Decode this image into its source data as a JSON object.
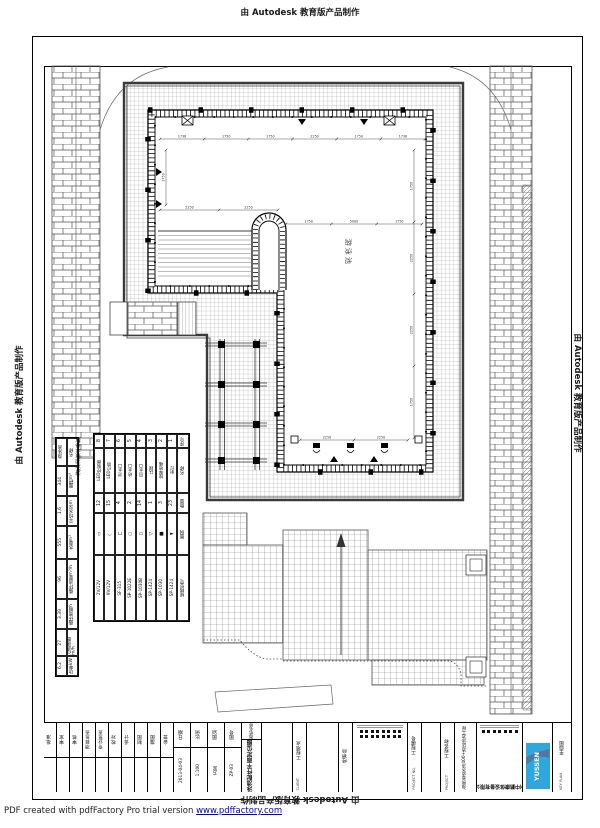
{
  "page": {
    "autodesk_stamp": "由 Autodesk 教育版产品制作",
    "pdf_footer_text": "PDF created with pdfFactory Pro trial version ",
    "pdf_footer_link": "www.pdffactory.com"
  },
  "colors": {
    "logo_blue": "#2fa7dd",
    "logo_swoosh": "#53779f",
    "link_blue": "#0000cc",
    "line_black": "#000000",
    "grid_gray": "#9a9a9a"
  },
  "pool": {
    "label": "游泳池"
  },
  "params_table": {
    "title": "游泳池技术参数",
    "rows": [
      [
        "游泳池",
        "名称"
      ],
      [
        "344",
        "面积m²"
      ],
      [
        "1.6",
        "平均水深m"
      ],
      [
        "555",
        "水量m³"
      ],
      [
        "96",
        "循环流量m³/h"
      ],
      [
        "3.39",
        "循环周期h"
      ],
      [
        "27",
        "过滤速度m/h"
      ],
      [
        "6.2",
        "功率kW"
      ]
    ],
    "row_heights": [
      28,
      30,
      30,
      33,
      40,
      30,
      27,
      20
    ]
  },
  "equipment_table": {
    "headers": [
      "序号",
      "名称",
      "数量",
      "图例",
      "规格型号"
    ],
    "row_heights": [
      14,
      45,
      20,
      42,
      66
    ],
    "items": [
      {
        "no": "1",
        "name": "射灯",
        "qty": "23",
        "symbol": "►",
        "model": "SP-1424"
      },
      {
        "no": "2",
        "name": "按摩喷嘴",
        "qty": "3",
        "symbol": "■",
        "model": "SP-1030"
      },
      {
        "no": "3",
        "name": "扶梯",
        "qty": "1",
        "symbol": "▷",
        "model": "SP-1424"
      },
      {
        "no": "4",
        "name": "回水口",
        "qty": "14",
        "symbol": "▭",
        "model": "SP-1030B"
      },
      {
        "no": "5",
        "name": "给水口",
        "qty": "2",
        "symbol": "○",
        "model": "SP-1022E"
      },
      {
        "no": "6",
        "name": "泄水口",
        "qty": "4",
        "symbol": "⊔",
        "model": "SF-315"
      },
      {
        "no": "7",
        "name": "LED灯带",
        "qty": "15",
        "symbol": "◡",
        "model": "9V/12V"
      },
      {
        "no": "8",
        "name": "LED控制器",
        "qty": "12",
        "symbol": "▯",
        "model": "2V/12V"
      }
    ]
  },
  "dims": {
    "top": [
      "1738",
      "1750",
      "1750",
      "2250",
      "1750",
      "1738"
    ],
    "left_lobe": [
      "2250",
      "2250"
    ],
    "mid": [
      "1750",
      "5000",
      "1750"
    ],
    "bottom": [
      "2250",
      "2250"
    ],
    "right": [
      "1750",
      "2250",
      "2250",
      "1750"
    ],
    "left": [
      "1750"
    ]
  },
  "titleblock": {
    "cells": [
      {
        "type": "sig",
        "w": 13,
        "label": "批准"
      },
      {
        "type": "sig",
        "w": 13,
        "label": "审定"
      },
      {
        "type": "sig",
        "w": 13,
        "label": "审核"
      },
      {
        "type": "sig",
        "w": 13,
        "label": "项目负责"
      },
      {
        "type": "sig",
        "w": 13,
        "label": "专业负责"
      },
      {
        "type": "sig",
        "w": 13,
        "label": "校对"
      },
      {
        "type": "sig",
        "w": 13,
        "label": "设计"
      },
      {
        "type": "sig",
        "w": 13,
        "label": "制图"
      },
      {
        "type": "sig",
        "w": 13,
        "label": "描图"
      },
      {
        "type": "sig",
        "w": 13,
        "label": "会签"
      },
      {
        "type": "kv",
        "w": 17,
        "k": "日期",
        "v": "2013-04-03"
      },
      {
        "type": "kv",
        "w": 17,
        "k": "比例",
        "v": "1:100"
      },
      {
        "type": "kv",
        "w": 17,
        "k": "图别",
        "v": "方案"
      },
      {
        "type": "kv",
        "w": 17,
        "k": "图号",
        "v": "ZP-03"
      },
      {
        "type": "title",
        "w": 20,
        "label": "图纸名称",
        "en": "TITLE",
        "value": "泳池配件平面定位图"
      },
      {
        "type": "blank",
        "w": 28
      },
      {
        "type": "sig2",
        "w": 14,
        "label": "工程地点",
        "en": "CLIENT"
      },
      {
        "type": "blank",
        "w": 30
      },
      {
        "type": "sig2",
        "w": 14,
        "label": "经销商",
        "en": ""
      },
      {
        "type": "stamp",
        "w": 55
      },
      {
        "type": "sig2",
        "w": 14,
        "label": "工程编号",
        "en": "PROJECT NO."
      },
      {
        "type": "blank",
        "w": 16
      },
      {
        "type": "sig2",
        "w": 14,
        "label": "工程名称",
        "en": "PROJECT"
      },
      {
        "type": "vtext2",
        "w": 22,
        "value": "海南省清水湾400+酒店泳池工程"
      },
      {
        "type": "company",
        "w": 46,
        "name": "广州中鹏康体设备有限公司"
      },
      {
        "type": "logo",
        "w": 30,
        "text": "YUSSEN"
      },
      {
        "type": "keyplan",
        "w": 19,
        "label": "平面图",
        "en": "KEY PLAN"
      }
    ]
  }
}
